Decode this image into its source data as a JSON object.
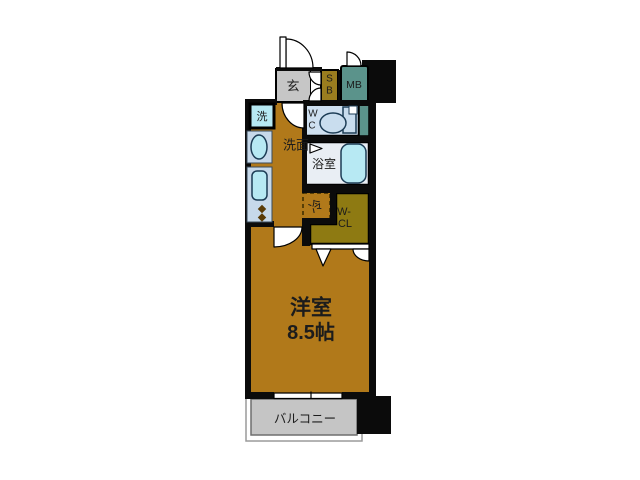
{
  "floorplan": {
    "labels": {
      "entrance": "玄",
      "shoebox_top": "S",
      "shoebox_bottom": "B",
      "meter_box": "MB",
      "washing_machine": "洗",
      "washroom": "洗面",
      "toilet_top": "W",
      "toilet_bottom": "C",
      "bathroom": "浴室",
      "refrigerator": "冷",
      "closet_top": "W-",
      "closet_bottom": "CL",
      "room_type": "洋室",
      "room_size": "8.5帖",
      "balcony": "バルコニー"
    },
    "colors": {
      "room_floor": "#b1791a",
      "entrance_floor": "#c6c6c6",
      "balcony_floor": "#c5c5c5",
      "shoebox": "#9a7d1f",
      "meter_box": "#5b938b",
      "closet": "#8e7a12",
      "toilet_room": "#cfe0f0",
      "bathroom_floor": "#e9eef4",
      "fixture_fill": "#b7e9f3",
      "counter_fill": "#c7d9ea",
      "wall": "#0b0b0b"
    }
  }
}
